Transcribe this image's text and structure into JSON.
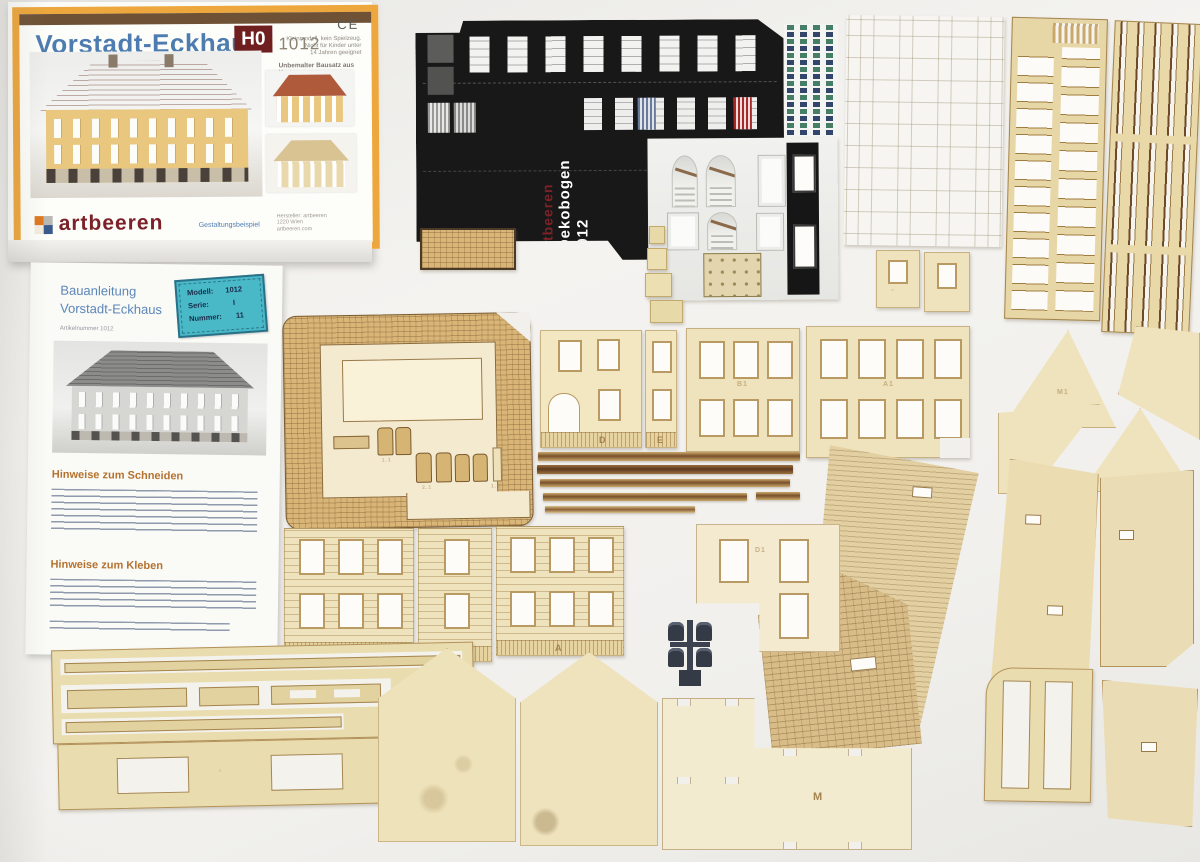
{
  "box": {
    "title": "Vorstadt-Eckhaus",
    "scale_badge": "H0",
    "article_number": "1012",
    "ce_mark": "CE",
    "warning_lines": [
      "Kleinmodell, kein Spielzeug.",
      "Nicht für Kinder unter",
      "14 Jahren geeignet"
    ],
    "subtitle": "Unbemalter Bausatz aus Karton",
    "brand": "artbeeren",
    "design_note": "Gestaltungsbeispiel",
    "fineprint_lines": [
      "Hersteller: artbeeren",
      "1220 Wien",
      "artbeeren.com"
    ],
    "accent_orange": "#eda73c",
    "title_blue": "#4d7cb0",
    "badge_red": "#6f1f1f"
  },
  "manual": {
    "title_line1": "Bauanleitung",
    "title_line2": "Vorstadt-Eckhaus",
    "article_line": "Artikelnummer   1012",
    "sticker": {
      "model_label": "Modell:",
      "model_value": "1012",
      "series_label": "Serie:",
      "series_value": "I",
      "number_label": "Nummer:",
      "number_value": "11",
      "color": "#49b9c7"
    },
    "section1_title": "Hinweise zum Schneiden",
    "section2_title": "Hinweise zum Kleben"
  },
  "deko": {
    "brand": "artbeeren",
    "title": "Dekobogen 1012",
    "brand_color": "#7a2228",
    "title_color": "#ffffff"
  },
  "parts": {
    "wall_d": "D",
    "wall_e": "E",
    "wall_b1": "B1",
    "wall_a1": "A1",
    "wall_b": "B",
    "wall_c": "C",
    "wall_a": "A",
    "wall_d1": "D1",
    "floor_m": "M",
    "gable_m1": "M1",
    "base_codes": [
      "1.1",
      "2.1",
      "1.2"
    ],
    "card_color": "#efe3bd",
    "etch_color": "#a5824e"
  }
}
